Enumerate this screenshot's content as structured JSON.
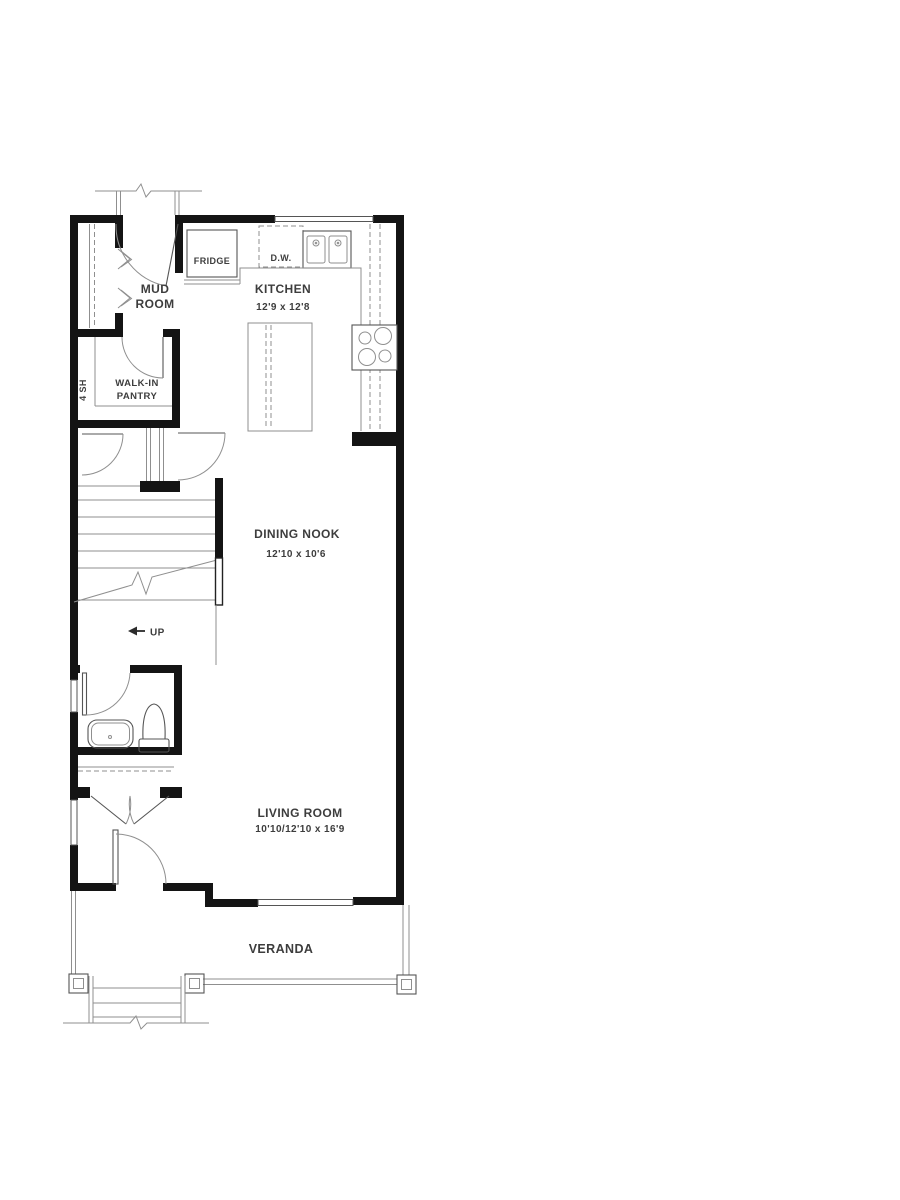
{
  "document": {
    "type": "architectural-floor-plan",
    "floor": "main level"
  },
  "colors": {
    "wall": "#141414",
    "line": "#8f8f8f",
    "accent_line": "#555555",
    "text": "#3d3d3d",
    "background": "#ffffff"
  },
  "rooms": {
    "mud_room": {
      "name_line1": "MUD",
      "name_line2": "ROOM"
    },
    "kitchen": {
      "name": "KITCHEN",
      "dims": "12'9 x 12'8"
    },
    "pantry": {
      "name_line1": "WALK-IN",
      "name_line2": "PANTRY",
      "shelf_label": "4 SH"
    },
    "dining_nook": {
      "name": "DINING NOOK",
      "dims": "12'10 x 10'6"
    },
    "living_room": {
      "name": "LIVING ROOM",
      "dims": "10'10/12'10 x 16'9"
    },
    "veranda": {
      "name": "VERANDA"
    }
  },
  "appliances": {
    "fridge": "FRIDGE",
    "dishwasher": "D.W."
  },
  "stairs": {
    "direction_label": "UP"
  }
}
